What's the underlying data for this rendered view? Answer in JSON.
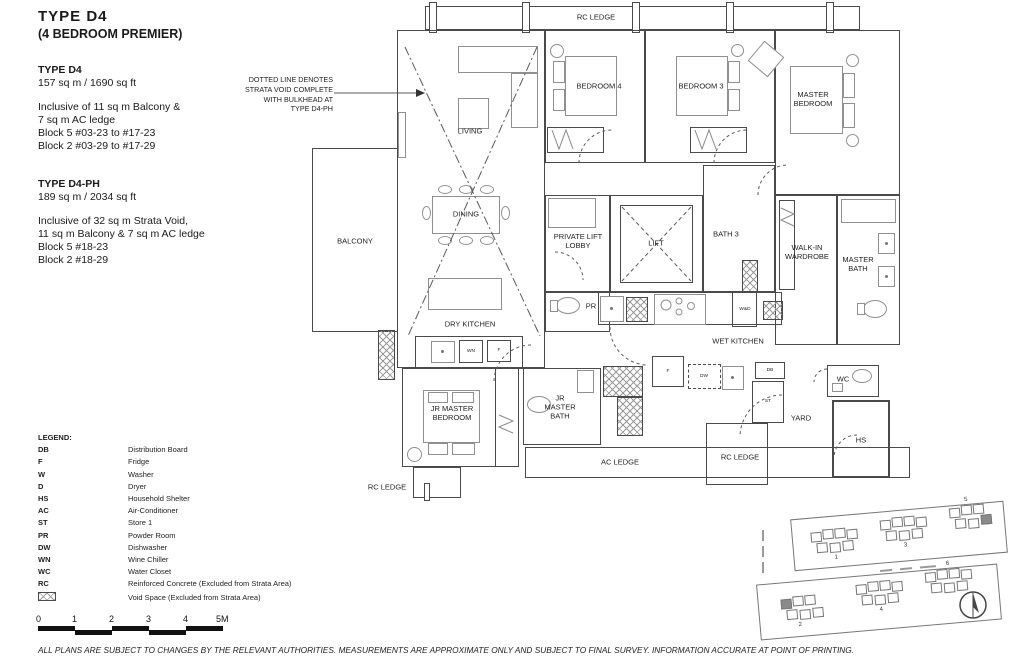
{
  "header": {
    "title": "TYPE  D4",
    "subtitle": "(4 BEDROOM PREMIER)"
  },
  "specs": [
    {
      "name": "TYPE D4",
      "area": "157 sq m / 1690 sq ft",
      "lines": [
        "Inclusive of 11 sq m Balcony &",
        "7 sq m AC ledge",
        "Block 5  #03-23 to #17-23",
        "Block 2  #03-29 to #17-29"
      ]
    },
    {
      "name": "TYPE D4-PH",
      "area": "189 sq m / 2034 sq ft",
      "lines": [
        "Inclusive of 32 sq m Strata Void,",
        "11 sq m Balcony & 7 sq m AC ledge",
        "Block 5  #18-23",
        "Block 2  #18-29"
      ]
    }
  ],
  "annotation": {
    "lines": [
      "DOTTED LINE DENOTES",
      "STRATA VOID COMPLETE",
      "WITH BULKHEAD AT",
      "TYPE D4-PH"
    ]
  },
  "plan_labels": {
    "rc_ledge_top": "RC LEDGE",
    "living": "LIVING",
    "dining": "DINING",
    "dry_kitchen": "DRY KITCHEN",
    "balcony": "BALCONY",
    "bedroom_4": "BEDROOM 4",
    "bedroom_3": "BEDROOM 3",
    "master_bedroom": "MASTER BEDROOM",
    "private_lift_lobby": "PRIVATE LIFT LOBBY",
    "lift": "LIFT",
    "bath_3": "BATH 3",
    "walk_in_wardrobe": "WALK-IN WARDROBE",
    "master_bath": "MASTER BATH",
    "pr": "PR",
    "wet_kitchen": "WET KITCHEN",
    "jr_master_bedroom": "JR MASTER BEDROOM",
    "jr_master_bath": "JR MASTER BATH",
    "ac_ledge": "AC LEDGE",
    "rc_ledge_bottom_left": "RC LEDGE",
    "rc_ledge_bottom_right": "RC LEDGE",
    "yard": "YARD",
    "wc": "WC",
    "hs": "HS"
  },
  "appliances": {
    "wn": "WN",
    "fridge_dry": "F",
    "fridge_wet": "F",
    "dw": "DW",
    "db": "DB",
    "st": "ST",
    "wd": "W&D"
  },
  "legend": {
    "title": "LEGEND:",
    "items": [
      {
        "code": "DB",
        "desc": "Distribution Board"
      },
      {
        "code": "F",
        "desc": "Fridge"
      },
      {
        "code": "W",
        "desc": "Washer"
      },
      {
        "code": "D",
        "desc": "Dryer"
      },
      {
        "code": "HS",
        "desc": "Household Shelter"
      },
      {
        "code": "AC",
        "desc": "Air-Conditioner"
      },
      {
        "code": "ST",
        "desc": "Store 1"
      },
      {
        "code": "PR",
        "desc": "Powder Room"
      },
      {
        "code": "DW",
        "desc": "Dishwasher"
      },
      {
        "code": "WN",
        "desc": "Wine Chiller"
      },
      {
        "code": "WC",
        "desc": "Water Closet"
      },
      {
        "code": "RC",
        "desc": "Reinforced Concrete (Excluded from Strata Area)"
      }
    ],
    "void_item": {
      "desc": "Void Space (Excluded from Strata Area)"
    }
  },
  "scale_bar": {
    "ticks": [
      "0",
      "1",
      "2",
      "3",
      "4",
      "5M"
    ]
  },
  "site_plan": {
    "top_blocks": [
      "1",
      "3",
      "5"
    ],
    "bottom_blocks": [
      "2",
      "4",
      "6"
    ]
  },
  "disclaimer": "ALL PLANS ARE SUBJECT TO CHANGES BY THE RELEVANT AUTHORITIES. MEASUREMENTS ARE APPROXIMATE ONLY AND SUBJECT TO FINAL SURVEY. INFORMATION ACCURATE AT POINT OF PRINTING.",
  "colors": {
    "plan_line": "#4a4a4a",
    "text": "#1a1a1a"
  }
}
